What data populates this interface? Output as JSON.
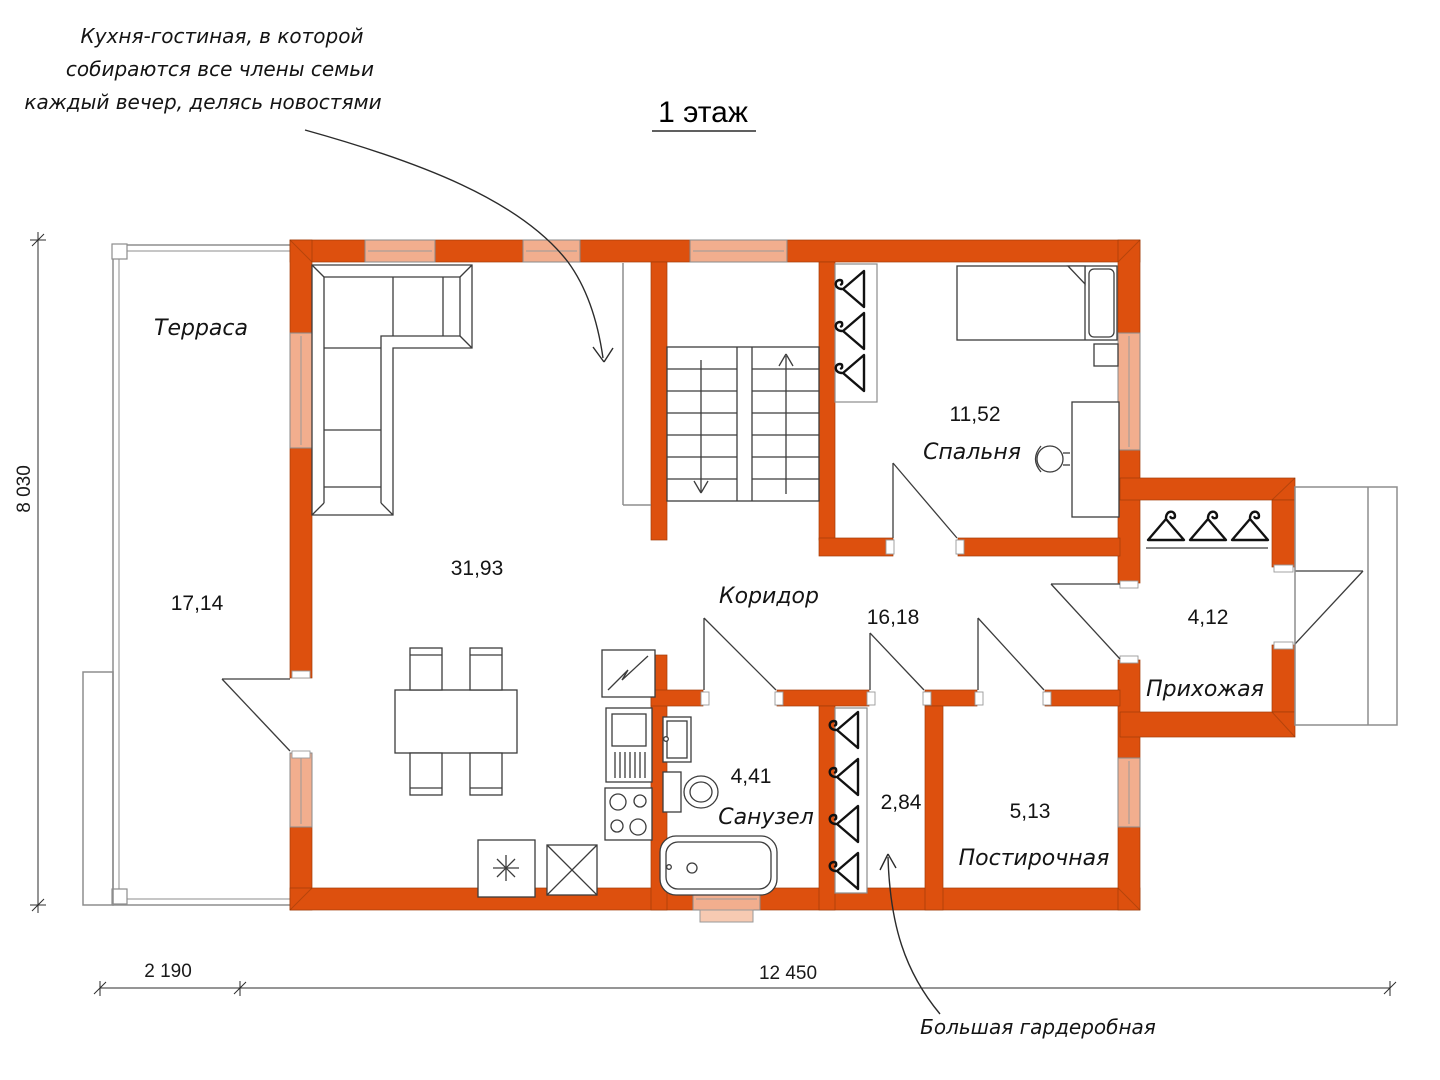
{
  "title": "1 этаж",
  "annotations": {
    "kitchen_note_line1": "Кухня-гостиная, в которой",
    "kitchen_note_line2": "собираются все члены семьи",
    "kitchen_note_line3": "каждый вечер, делясь новостями",
    "wardrobe_note": "Большая гардеробная"
  },
  "rooms": {
    "terrace": {
      "name": "Терраса",
      "area": "17,14"
    },
    "kitchen_living": {
      "area": "31,93"
    },
    "bedroom": {
      "name": "Спальня",
      "area": "11,52"
    },
    "corridor": {
      "name": "Коридор",
      "area": "16,18"
    },
    "bathroom": {
      "name": "Санузел",
      "area": "4,41"
    },
    "wardrobe": {
      "area": "2,84"
    },
    "laundry": {
      "name": "Постирочная",
      "area": "5,13"
    },
    "hallway": {
      "name": "Прихожая",
      "area": "4,12"
    }
  },
  "dimensions": {
    "height": "8 030",
    "terrace_width": "2 190",
    "house_width": "12 450"
  },
  "colors": {
    "wall": "#dd500e",
    "window": "#f2ae8e",
    "furniture_line": "#3c3c3c",
    "terrace_line": "#8d8d8d"
  }
}
